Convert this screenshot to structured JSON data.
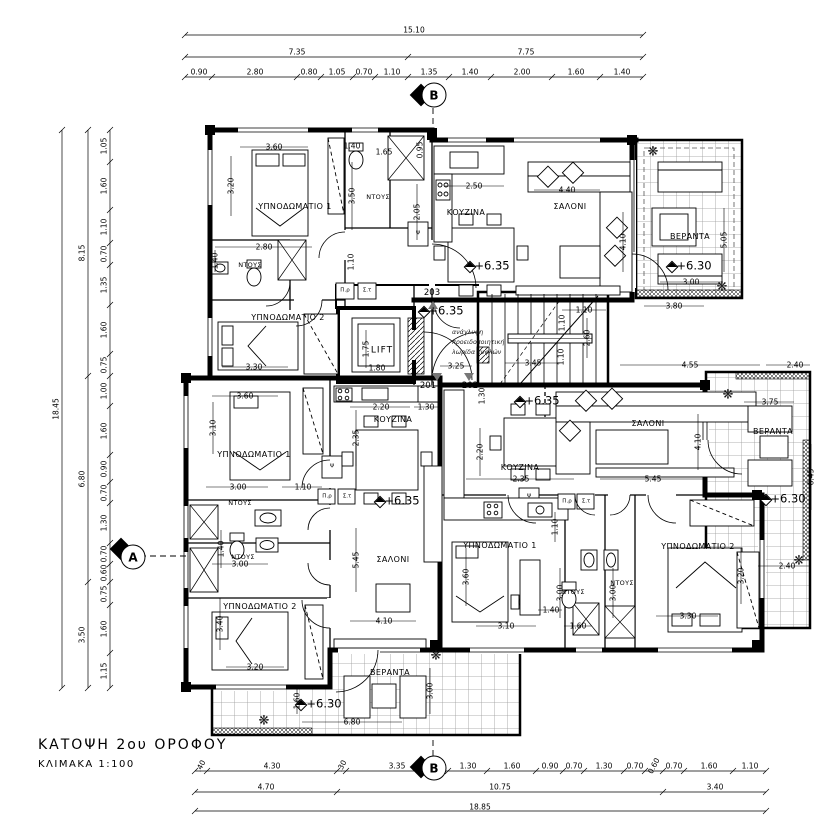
{
  "title_block": {
    "title": "ΚΑΤΟΨΗ 2ου ΟΡΟΦΟΥ",
    "scale": "ΚΛΙΜΑΚΑ   1:100"
  },
  "section_markers": {
    "top_b": "B",
    "bottom_b": "B",
    "left_a": "A"
  },
  "levels": {
    "l1": "+6.35",
    "l2": "+6.30",
    "l3": "+6.35",
    "l4": "+6.35",
    "l5": "+6.35",
    "l6": "+6.30",
    "l7": "+6.30"
  },
  "apartments": {
    "a201": "201",
    "a202": "202",
    "a203": "203"
  },
  "rooms": {
    "apt203": {
      "bedroom1": "ΥΠΝΟΔΩΜΑΤΙΟ 1",
      "bedroom2": "ΥΠΝΟΔΩΜΑΤΙΟ 2",
      "shower1": "ΝΤΟΥΣ",
      "shower2": "ΝΤΟΥΣ",
      "kitchen": "ΚΟΥΖΙΝΑ",
      "living": "ΣΑΛΟΝΙ",
      "veranda": "ΒΕΡΑΝΤΑ"
    },
    "apt201": {
      "bedroom1": "ΥΠΝΟΔΩΜΑΤΙΟ 1",
      "bedroom2": "ΥΠΝΟΔΩΜΑΤΙΟ 2",
      "shower1": "ΝΤΟΥΣ",
      "shower2": "ΝΤΟΥΣ",
      "kitchen": "ΚΟΥΖΙΝΑ",
      "living": "ΣΑΛΟΝΙ",
      "veranda": "ΒΕΡΑΝΤΑ"
    },
    "apt202": {
      "bedroom1": "ΥΠΝΟΔΩΜΑΤΙΟ 1",
      "bedroom2": "ΥΠΝΟΔΩΜΑΤΙΟ 2",
      "shower1": "ΝΤΟΥΣ",
      "shower2": "ΝΤΟΥΣ",
      "kitchen": "ΚΟΥΖΙΝΑ",
      "living": "ΣΑΛΟΝΙ",
      "veranda": "ΒΕΡΑΝΤΑ"
    },
    "core": {
      "lift": "LIFT"
    }
  },
  "note_lines": [
    "ανάγλυφη",
    "προειδοποιητική",
    "λωρίδα τυφλών"
  ],
  "small_labels": {
    "pr": "Π.ρ",
    "st": "Σ.τ",
    "psi": "Ψ"
  },
  "dims": {
    "top": {
      "total": "15.10",
      "row2": [
        "7.35",
        "7.75"
      ],
      "row3": [
        "0.90",
        "2.80",
        "0.80",
        "1.05",
        "0.70",
        "1.10",
        "1.35",
        "1.40",
        "2.00",
        "1.60",
        "1.40"
      ]
    },
    "left": {
      "total": "18.45",
      "row2": [
        "8.15",
        "6.80",
        "3.50"
      ],
      "row3": [
        "1.05",
        "1.60",
        "1.10",
        "0.70",
        "1.35",
        "1.60",
        "0.75",
        "1.00",
        "1.60",
        "0.90",
        "0.70",
        "1.30",
        "0.70",
        "0.60",
        "0.75",
        "1.60",
        "1.15"
      ]
    },
    "bottom": {
      "total": "18.85",
      "row2": [
        "4.70",
        "10.75",
        "3.40"
      ],
      "row3": [
        ".40",
        "4.30",
        ".30",
        "3.35",
        "1.30",
        "1.60",
        "0.90",
        "0.70",
        "1.30",
        "0.70",
        "0.60",
        "0.70",
        "1.60",
        "1.10"
      ]
    },
    "interior": [
      "3.60",
      "3.20",
      "1.40",
      "1.65",
      "0.95",
      "3.50",
      "2.80",
      "1.40",
      "1.10",
      "2.05",
      "2.50",
      "4.40",
      "4.10",
      "5.05",
      "3.00",
      "3.80",
      "3.30",
      "1.75",
      "1.80",
      "3.25",
      "3.45",
      "1.10",
      "2.60",
      "1.10",
      "1.10",
      "4.55",
      "2.40",
      "3.60",
      "3.10",
      "2.20",
      "1.30",
      "2.35",
      "3.00",
      "1.10",
      "1.40",
      "3.00",
      "3.40",
      "3.20",
      "5.45",
      "4.10",
      "1.60",
      "6.80",
      "3.00",
      "1.30",
      "2.20",
      "2.35",
      "5.45",
      "4.10",
      "1.10",
      "3.60",
      "3.10",
      "3.00",
      "1.60",
      "1.40",
      "3.00",
      "3.30",
      "3.20",
      "3.75",
      "6.45",
      "2.40"
    ]
  }
}
